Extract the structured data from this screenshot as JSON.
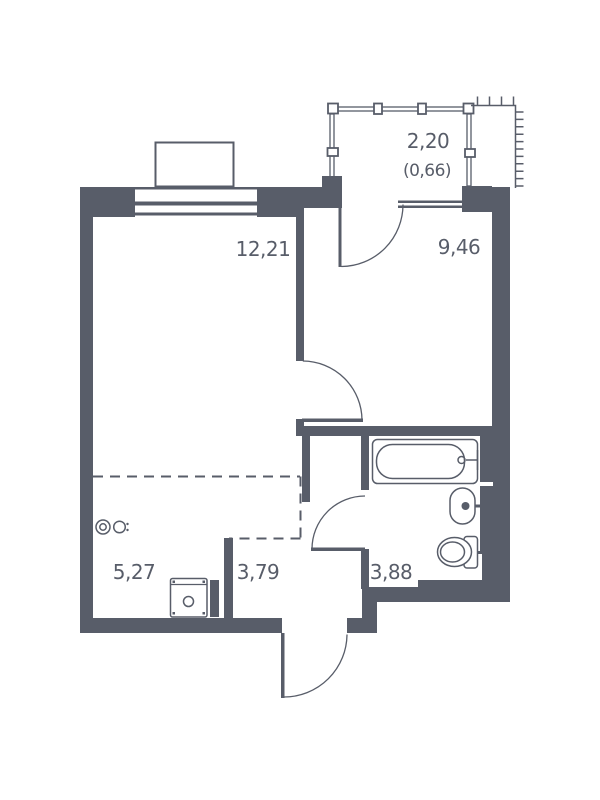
{
  "plan": {
    "type": "apartment-floor-plan",
    "colors": {
      "ink": "#585d69",
      "background": "#ffffff"
    },
    "rooms": {
      "living": {
        "area": "12,21"
      },
      "kitchen": {
        "area": "9,46"
      },
      "balcony": {
        "area": "2,20",
        "area_secondary": "(0,66)"
      },
      "storage": {
        "area": "5,27"
      },
      "hall": {
        "area": "3,79"
      },
      "bathroom": {
        "area": "3,88"
      }
    },
    "fixtures": [
      "bathtub",
      "sink",
      "toilet",
      "washing-machine",
      "balcony-railing",
      "wall-outlets"
    ]
  }
}
